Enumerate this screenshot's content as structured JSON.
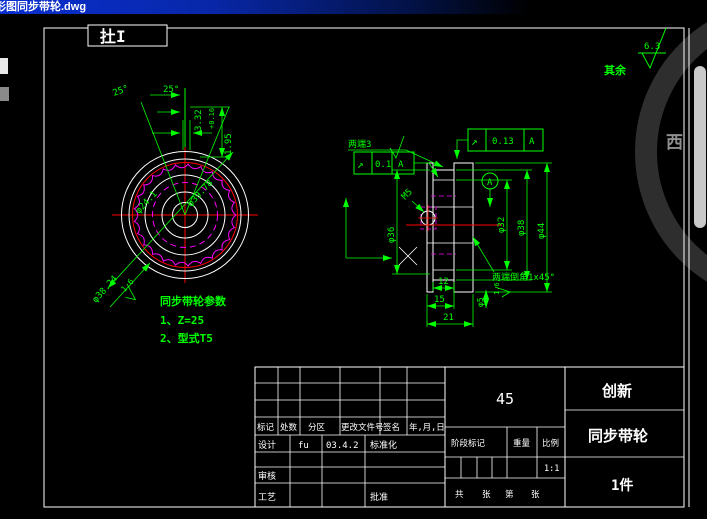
{
  "window": {
    "title": "形图同步带轮.dwg"
  },
  "sheet": {
    "view_label": "扗I",
    "extra_roughness_label": "其余",
    "extra_roughness_value": "6.3"
  },
  "front_view": {
    "angle_left": "25°",
    "angle_right": "25°",
    "pitch_dim": "3.32",
    "pitch_tol": "+0.16",
    "depth_dim": "1.95",
    "od_dim": "φ38.24",
    "od_roughness": "1.6",
    "bore_dim": "φ24.1",
    "pitch_dia": "φ39.78",
    "notes_title": "同步带轮参数",
    "note_1": "1、Z=25",
    "note_2": "2、型式T5"
  },
  "side_view": {
    "ends_note": "两端3",
    "gdt_top": {
      "symbol": "↗",
      "value": "0.1",
      "datum": "A"
    },
    "gdt_right": {
      "symbol": "↗",
      "value": "0.13",
      "datum": "A"
    },
    "datum_label": "A",
    "thread_label": "M5",
    "dia_left": "φ36",
    "dia_1": "φ32",
    "dia_2": "φ38",
    "dia_3": "φ44",
    "width_1": "12",
    "width_2": "15",
    "width_3": "21",
    "small_dia": "φ5",
    "small_roughness": "1.6",
    "chamfer_note": "两端倒角1x45°"
  },
  "title_block": {
    "col_mark": "标记",
    "col_count": "处数",
    "col_zone": "分区",
    "col_doc": "更改文件号",
    "col_sign": "签名",
    "col_date": "年,月,日",
    "design_label": "设计",
    "designer": "fu",
    "date": "03.4.2",
    "std_label": "标准化",
    "audit_label": "审核",
    "process_label": "工艺",
    "approve_label": "批准",
    "material": "45",
    "company": "创新",
    "part_name": "同步带轮",
    "quantity": "1件",
    "stage_label": "阶段标记",
    "weight_label": "重量",
    "scale_label": "比例",
    "scale_value": "1:1",
    "sheet_total_label": "共",
    "sheet_unit1": "张",
    "sheet_no_label": "第",
    "sheet_unit2": "张"
  },
  "watermark": {
    "char": "西"
  },
  "colors": {
    "dimension": "#00ff00",
    "geometry": "#ffffff",
    "center": "#ff0000",
    "teeth": "#ff00ff",
    "titlebar": "#0a2fd0"
  }
}
